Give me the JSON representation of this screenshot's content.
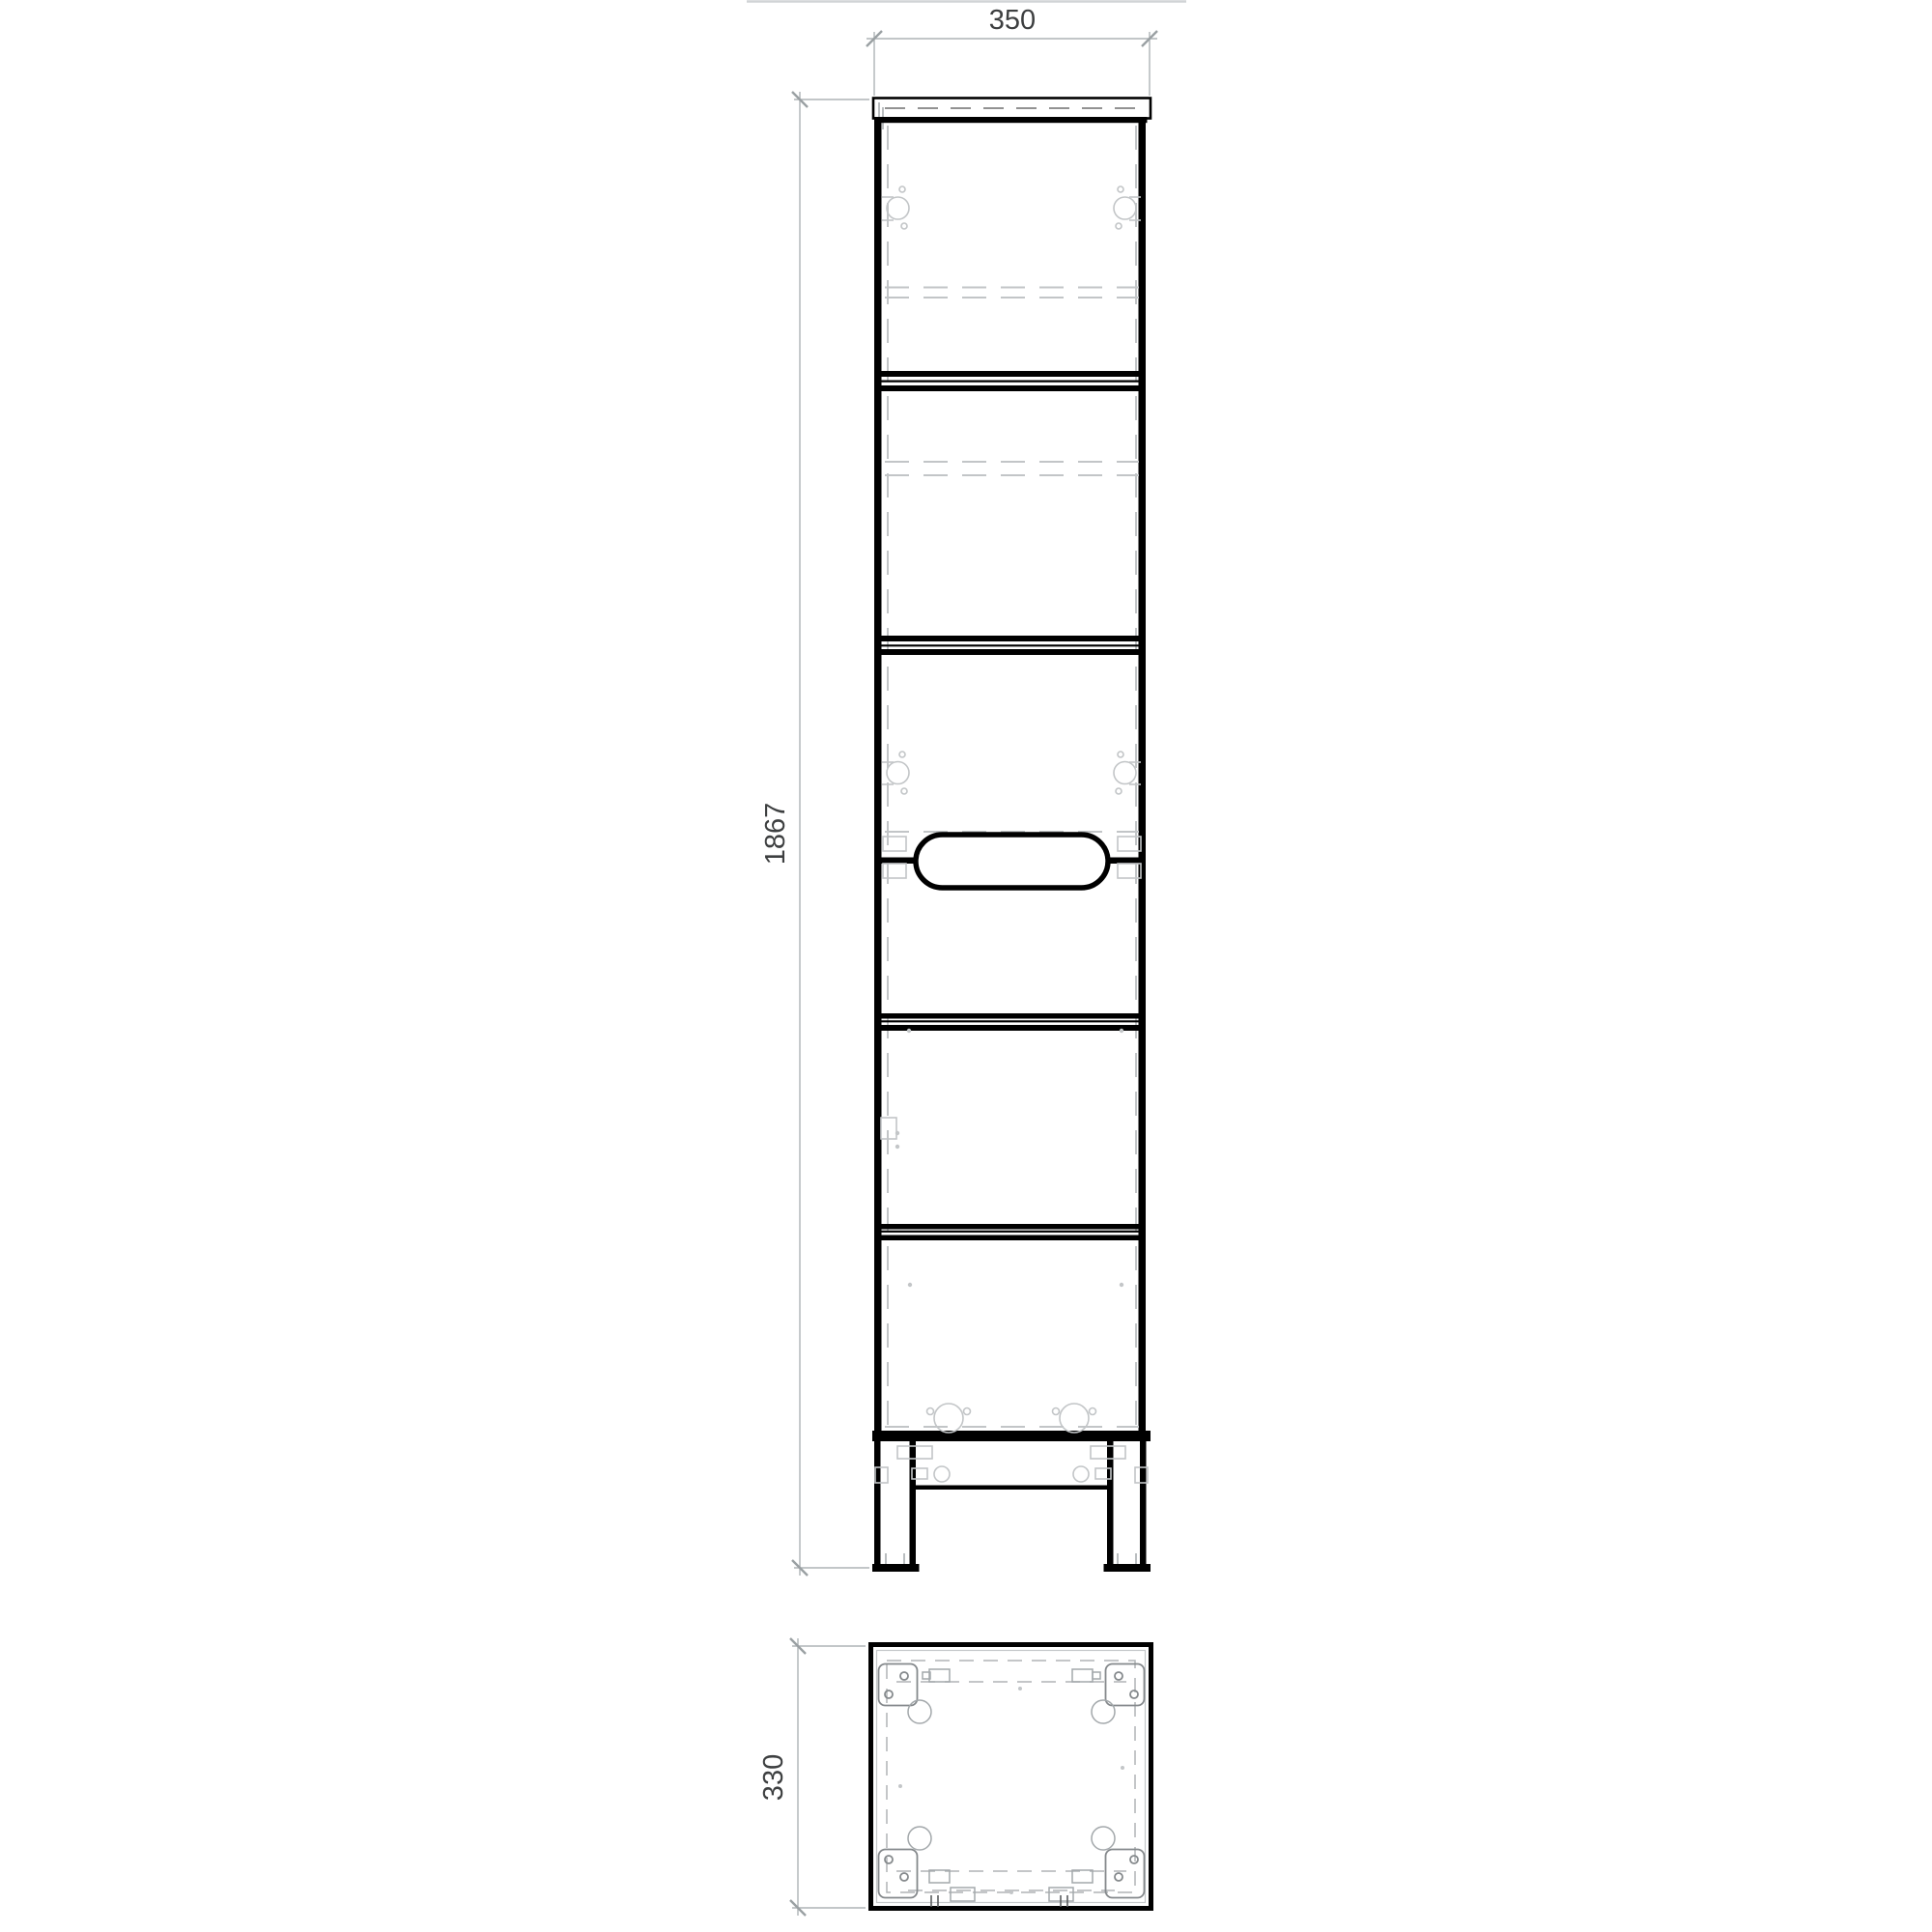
{
  "dimensions": {
    "width": "350",
    "height": "1867",
    "depth": "330"
  },
  "colors": {
    "outline": "#000000",
    "hidden_line": "#c2c5c7",
    "dimension_line": "#aeb3b6",
    "dimension_text": "#3d3f40",
    "background": "#ffffff"
  }
}
